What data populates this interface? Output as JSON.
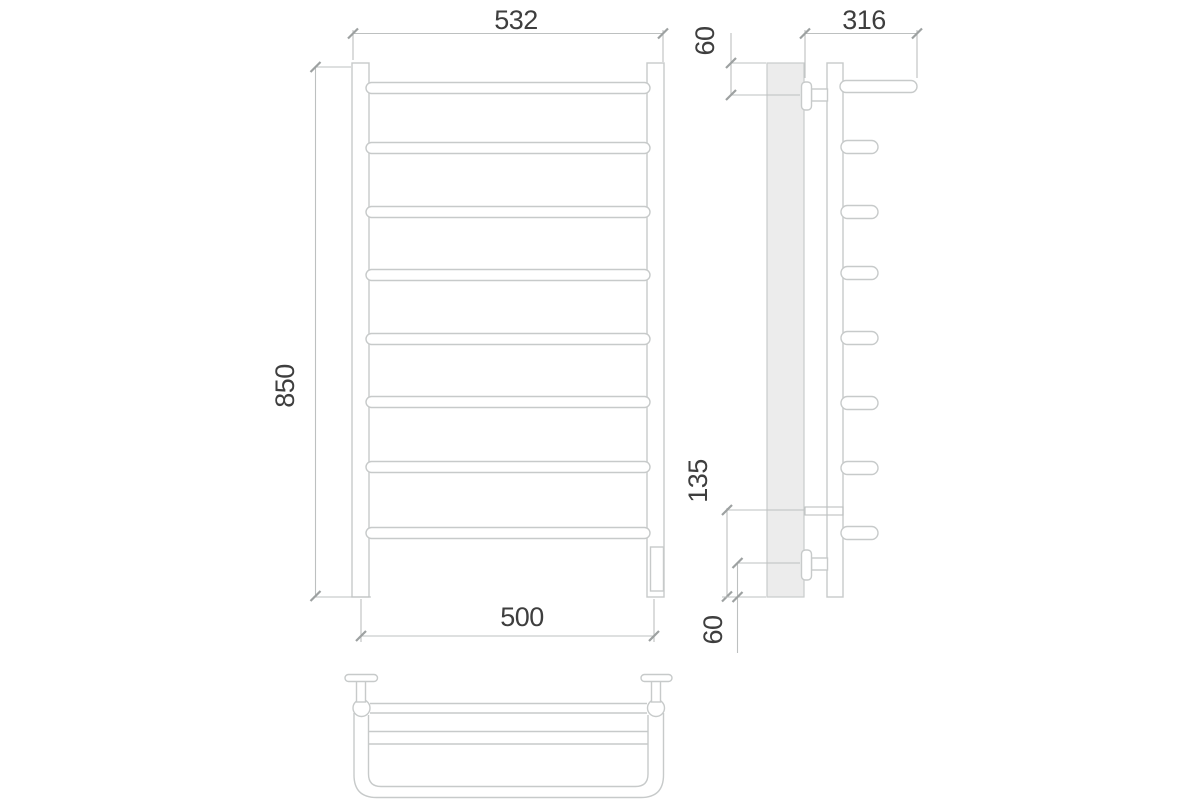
{
  "drawing": {
    "subject": "heated-towel-rail-three-view-technical-drawing",
    "bar_count_front_view": 8,
    "dimensions": {
      "overall_width": "532",
      "overall_height": "850",
      "axis_width": "500",
      "shelf_depth": "316",
      "top_bracket_offset": "60",
      "bottom_connection_offset": "135",
      "bottom_bracket_offset": "60"
    },
    "colors": {
      "background": "#ffffff",
      "outline": "#c7caca",
      "dimension_line": "#bdc0c0",
      "tick": "#9da1a1",
      "label_text": "#3e3e3e",
      "wall_fill": "#ececec"
    }
  }
}
